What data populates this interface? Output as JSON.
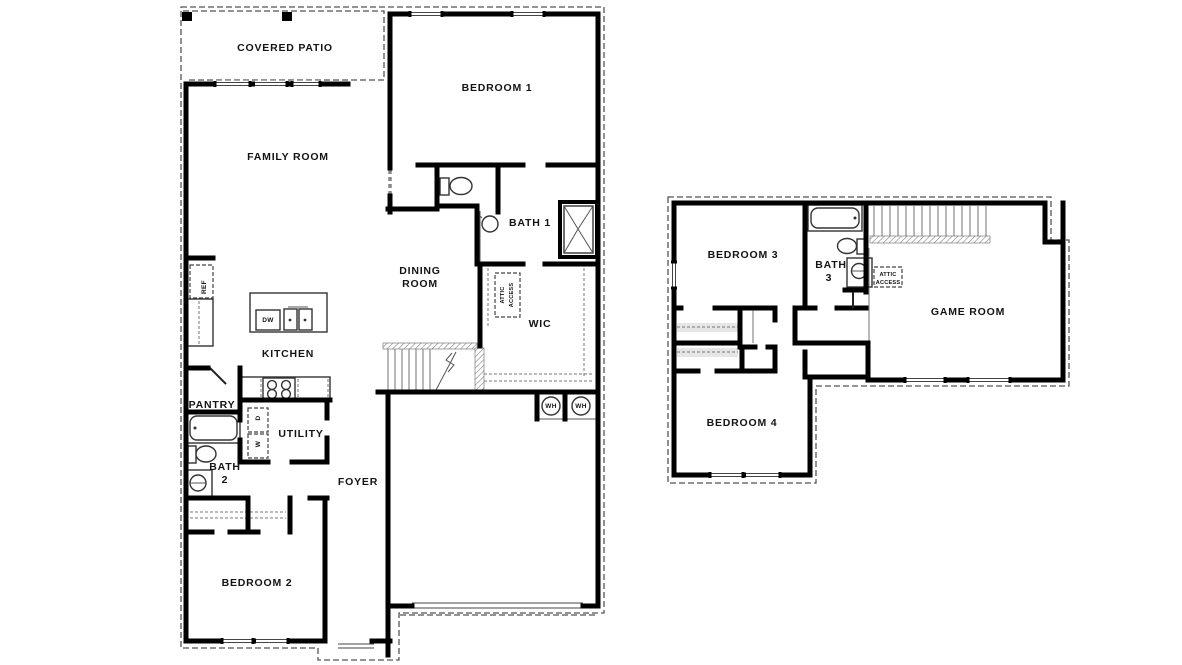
{
  "drawing": {
    "type": "residential-floor-plan",
    "floors": [
      "first-floor",
      "second-floor"
    ],
    "colors": {
      "walls": "#000000",
      "background": "#ffffff",
      "fixtures": "#333333",
      "dashes": "#555555"
    }
  },
  "labels": {
    "covered_patio": "COVERED PATIO",
    "family_room": "FAMILY ROOM",
    "bedroom_1": "BEDROOM 1",
    "bath_1": "BATH 1",
    "dining_line1": "DINING",
    "dining_line2": "ROOM",
    "wic": "WIC",
    "attic_line1": "ATTIC",
    "attic_line2": "ACCESS",
    "kitchen": "KITCHEN",
    "pantry": "PANTRY",
    "utility": "UTILITY",
    "bath2_line1": "BATH",
    "bath2_line2": "2",
    "foyer": "FOYER",
    "bedroom_2": "BEDROOM 2",
    "ref": "REF",
    "dw": "DW",
    "dryer": "D",
    "washer": "W",
    "wh": "WH",
    "bedroom_3": "BEDROOM 3",
    "bath3_line1": "BATH",
    "bath3_line2": "3",
    "game_room": "GAME ROOM",
    "bedroom_4": "BEDROOM 4"
  }
}
